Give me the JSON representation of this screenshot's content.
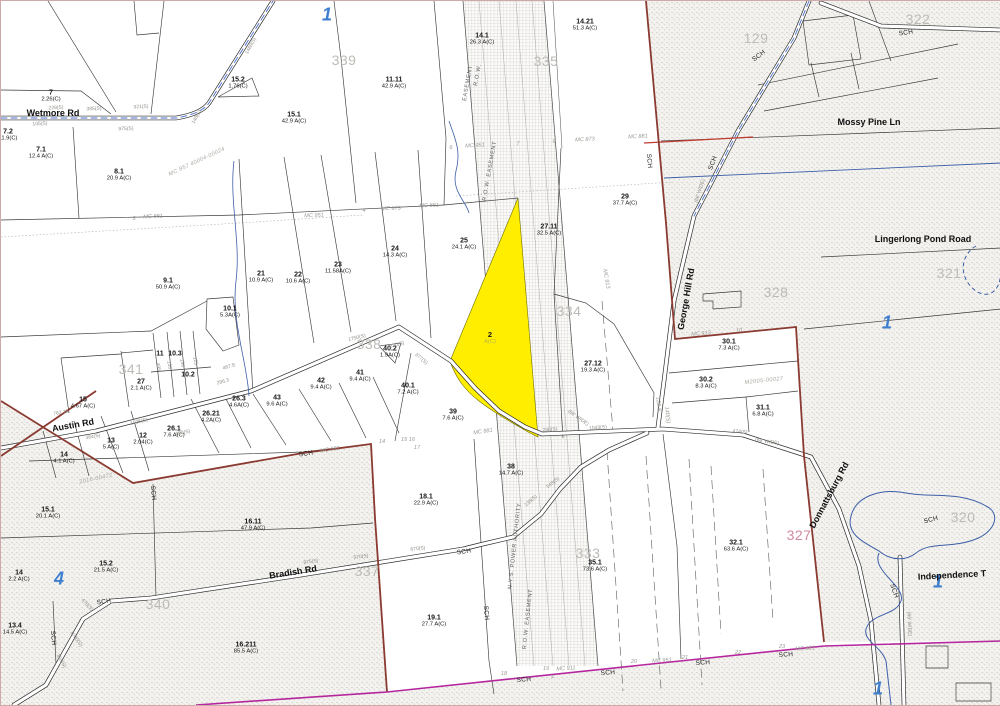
{
  "map": {
    "title": "Tax parcel map",
    "colors": {
      "highlight_parcel": "#ffee00",
      "boundary_maroon": "#8a3a30",
      "boundary_magenta": "#b5279d",
      "red_line": "#c03c30",
      "water": "#3c5fa8",
      "road_centerline": "#4a6fd0",
      "zone_number": "#3f7fd0",
      "sheet_number": "#bdbbb6"
    },
    "highlight_parcel": {
      "id": "2",
      "sub": "A(C)",
      "x": 489,
      "y": 337
    },
    "parcel_labels": [
      {
        "id": "7",
        "a": "2.26(C)",
        "x": 50,
        "y": 95
      },
      {
        "id": "7.2",
        "a": "11.9(C)",
        "x": 7,
        "y": 134
      },
      {
        "id": "7.1",
        "a": "12.4 A(C)",
        "x": 40,
        "y": 152
      },
      {
        "id": "8.1",
        "a": "20.9 A(C)",
        "x": 118,
        "y": 174
      },
      {
        "id": "15.2",
        "a": "1.76(C)",
        "x": 237,
        "y": 82
      },
      {
        "id": "15.1",
        "a": "42.9 A(C)",
        "x": 293,
        "y": 117
      },
      {
        "id": "11.11",
        "a": "42.9 A(C)",
        "x": 393,
        "y": 82
      },
      {
        "id": "14.1",
        "a": "26.3 A(C)",
        "x": 481,
        "y": 38
      },
      {
        "id": "14.21",
        "a": "51.3 A(C)",
        "x": 584,
        "y": 24
      },
      {
        "id": "29",
        "a": "37.7 A(C)",
        "x": 624,
        "y": 199
      },
      {
        "id": "27.11",
        "a": "32.5 A(C)",
        "x": 548,
        "y": 229
      },
      {
        "id": "25",
        "a": "24.1 A(C)",
        "x": 463,
        "y": 243
      },
      {
        "id": "24",
        "a": "14.3 A(C)",
        "x": 394,
        "y": 251
      },
      {
        "id": "23",
        "a": "11.58A(C)",
        "x": 337,
        "y": 267
      },
      {
        "id": "22",
        "a": "10.6 A(C)",
        "x": 297,
        "y": 277
      },
      {
        "id": "21",
        "a": "10.9 A(C)",
        "x": 260,
        "y": 276
      },
      {
        "id": "9.1",
        "a": "50.9 A(C)",
        "x": 167,
        "y": 283
      },
      {
        "id": "10.1",
        "a": "5.3A(C)",
        "x": 229,
        "y": 311
      },
      {
        "id": "27.12",
        "a": "19.3 A(C)",
        "x": 592,
        "y": 366
      },
      {
        "id": "30.1",
        "a": "7.3 A(C)",
        "x": 728,
        "y": 344
      },
      {
        "id": "30.2",
        "a": "8.3 A(C)",
        "x": 705,
        "y": 382
      },
      {
        "id": "31.1",
        "a": "6.8 A(C)",
        "x": 762,
        "y": 410
      },
      {
        "id": "40.2",
        "a": "1.9A(C)",
        "x": 389,
        "y": 351
      },
      {
        "id": "41",
        "a": "9.4 A(C)",
        "x": 359,
        "y": 375
      },
      {
        "id": "42",
        "a": "9.4 A(C)",
        "x": 320,
        "y": 383
      },
      {
        "id": "43",
        "a": "9.6 A(C)",
        "x": 276,
        "y": 400
      },
      {
        "id": "40.1",
        "a": "7.2 A(C)",
        "x": 407,
        "y": 388
      },
      {
        "id": "39",
        "a": "7.6 A(C)",
        "x": 452,
        "y": 414
      },
      {
        "id": "11",
        "a": "",
        "x": 159,
        "y": 353
      },
      {
        "id": "10.3",
        "a": "",
        "x": 174,
        "y": 353
      },
      {
        "id": "10.2",
        "a": "",
        "x": 187,
        "y": 374
      },
      {
        "id": "15",
        "a": "4.67 A(C)",
        "x": 82,
        "y": 402
      },
      {
        "id": "27",
        "a": "2.1 A(C)",
        "x": 140,
        "y": 384
      },
      {
        "id": "26.1",
        "a": "7.6 A(C)",
        "x": 173,
        "y": 431
      },
      {
        "id": "26.21",
        "a": "4.2A(C)",
        "x": 210,
        "y": 416
      },
      {
        "id": "26.3",
        "a": "4.6A(C)",
        "x": 238,
        "y": 401
      },
      {
        "id": "13",
        "a": "5 A(C)",
        "x": 110,
        "y": 443
      },
      {
        "id": "12",
        "a": "2.04(C)",
        "x": 142,
        "y": 438
      },
      {
        "id": "14",
        "a": "4.1 A(C)",
        "x": 63,
        "y": 457
      },
      {
        "id": "38",
        "a": "14.7 A(C)",
        "x": 510,
        "y": 469
      },
      {
        "id": "18.1",
        "a": "22.9 A(C)",
        "x": 425,
        "y": 499
      },
      {
        "id": "19.1",
        "a": "27.7 A(C)",
        "x": 433,
        "y": 620
      },
      {
        "id": "35.1",
        "a": "73.6 A(C)",
        "x": 594,
        "y": 565
      },
      {
        "id": "32.1",
        "a": "63.6 A(C)",
        "x": 735,
        "y": 545
      },
      {
        "id": "15.1",
        "a": "20.1 A(C)",
        "x": 47,
        "y": 512
      },
      {
        "id": "15.2",
        "a": "21.5 A(C)",
        "x": 105,
        "y": 566
      },
      {
        "id": "16.11",
        "a": "47.9 A(C)",
        "x": 252,
        "y": 524
      },
      {
        "id": "14",
        "a": "2.2 A(C)",
        "x": 18,
        "y": 575
      },
      {
        "id": "13.4",
        "a": "14.5 A(C)",
        "x": 14,
        "y": 628
      },
      {
        "id": "16.211",
        "a": "85.5 A(C)",
        "x": 245,
        "y": 647
      }
    ],
    "sheet_numbers": [
      {
        "t": "339",
        "x": 343,
        "y": 59
      },
      {
        "t": "335",
        "x": 545,
        "y": 60
      },
      {
        "t": "334",
        "x": 568,
        "y": 310
      },
      {
        "t": "338",
        "x": 368,
        "y": 343
      },
      {
        "t": "341",
        "x": 130,
        "y": 368
      },
      {
        "t": "129",
        "x": 755,
        "y": 37
      },
      {
        "t": "322",
        "x": 917,
        "y": 18
      },
      {
        "t": "328",
        "x": 775,
        "y": 291
      },
      {
        "t": "321",
        "x": 948,
        "y": 272
      },
      {
        "t": "320",
        "x": 962,
        "y": 516
      },
      {
        "t": "327",
        "x": 798,
        "y": 534,
        "c": "#cf8aa0"
      },
      {
        "t": "333",
        "x": 587,
        "y": 552
      },
      {
        "t": "340",
        "x": 157,
        "y": 603
      },
      {
        "t": "337",
        "x": 366,
        "y": 570
      }
    ],
    "zone_numbers": [
      {
        "t": "1",
        "x": 326,
        "y": 14
      },
      {
        "t": "1",
        "x": 886,
        "y": 322
      },
      {
        "t": "1",
        "x": 937,
        "y": 581
      },
      {
        "t": "1",
        "x": 877,
        "y": 688
      },
      {
        "t": "4",
        "x": 58,
        "y": 578
      }
    ],
    "road_labels": [
      {
        "t": "Wetmore Rd",
        "x": 52,
        "y": 112,
        "r": 0
      },
      {
        "t": "Austin Rd",
        "x": 72,
        "y": 424,
        "r": -10
      },
      {
        "t": "Bradish Rd",
        "x": 292,
        "y": 571,
        "r": -9
      },
      {
        "t": "George Hill Rd",
        "x": 685,
        "y": 298,
        "r": -80
      },
      {
        "t": "Mossy Pine Ln",
        "x": 868,
        "y": 121,
        "r": 0
      },
      {
        "t": "Lingerlong Pond Road",
        "x": 922,
        "y": 238,
        "r": 0
      },
      {
        "t": "Donnattsburg Rd",
        "x": 828,
        "y": 494,
        "r": -62
      },
      {
        "t": "Independence T",
        "x": 951,
        "y": 574,
        "r": -3
      }
    ],
    "sch_labels": [
      {
        "x": 305,
        "y": 453,
        "r": -8
      },
      {
        "x": 103,
        "y": 601,
        "r": -8
      },
      {
        "x": 463,
        "y": 551,
        "r": -8
      },
      {
        "x": 485,
        "y": 612,
        "r": 85
      },
      {
        "x": 152,
        "y": 492,
        "r": 85
      },
      {
        "x": 52,
        "y": 637,
        "r": 85
      },
      {
        "x": 523,
        "y": 679,
        "r": -4
      },
      {
        "x": 607,
        "y": 672,
        "r": -4
      },
      {
        "x": 702,
        "y": 662,
        "r": -4
      },
      {
        "x": 785,
        "y": 654,
        "r": -4
      },
      {
        "x": 758,
        "y": 55,
        "r": -38
      },
      {
        "x": 712,
        "y": 162,
        "r": -70
      },
      {
        "x": 905,
        "y": 32,
        "r": -8
      },
      {
        "x": 930,
        "y": 519,
        "r": -15
      },
      {
        "x": 893,
        "y": 590,
        "r": 70
      },
      {
        "x": 648,
        "y": 160,
        "r": 85
      }
    ],
    "line_labels": [
      {
        "t": "6",
        "x": 450,
        "y": 147,
        "r": -3
      },
      {
        "t": "MC 951",
        "x": 474,
        "y": 145,
        "r": -3
      },
      {
        "t": "7",
        "x": 517,
        "y": 143,
        "r": -3
      },
      {
        "t": "9",
        "x": 553,
        "y": 141,
        "r": -3
      },
      {
        "t": "MC 873",
        "x": 584,
        "y": 139,
        "r": -3
      },
      {
        "t": "MC 881",
        "x": 637,
        "y": 136,
        "r": -3
      },
      {
        "t": "3",
        "x": 133,
        "y": 218,
        "r": 0
      },
      {
        "t": "MC 881",
        "x": 152,
        "y": 216,
        "r": -2
      },
      {
        "t": "MC 951",
        "x": 313,
        "y": 215,
        "r": -2
      },
      {
        "t": "4",
        "x": 363,
        "y": 210,
        "r": 0
      },
      {
        "t": "MC 873",
        "x": 390,
        "y": 208,
        "r": -2
      },
      {
        "t": "MC 881",
        "x": 428,
        "y": 205,
        "r": -2
      },
      {
        "t": "MC 951",
        "x": 329,
        "y": 449,
        "r": -8
      },
      {
        "t": "14",
        "x": 381,
        "y": 441,
        "r": 0
      },
      {
        "t": "15 16",
        "x": 407,
        "y": 439,
        "r": 0
      },
      {
        "t": "17",
        "x": 416,
        "y": 447,
        "r": 0
      },
      {
        "t": "MC 881",
        "x": 482,
        "y": 431,
        "r": -8
      },
      {
        "t": "18",
        "x": 503,
        "y": 673,
        "r": 0
      },
      {
        "t": "F",
        "x": 552,
        "y": 677,
        "r": 0
      },
      {
        "t": "19",
        "x": 545,
        "y": 668,
        "r": 0
      },
      {
        "t": "MC 911",
        "x": 565,
        "y": 668,
        "r": -4
      },
      {
        "t": "20",
        "x": 633,
        "y": 661,
        "r": 0
      },
      {
        "t": "MC 951",
        "x": 661,
        "y": 660,
        "r": -4
      },
      {
        "t": "21",
        "x": 684,
        "y": 657,
        "r": 0
      },
      {
        "t": "22",
        "x": 737,
        "y": 652,
        "r": 0
      },
      {
        "t": "23",
        "x": 781,
        "y": 646,
        "r": 0
      },
      {
        "t": "MC 881",
        "x": 804,
        "y": 648,
        "r": -4
      },
      {
        "t": "MC 913",
        "x": 700,
        "y": 333,
        "r": -5
      },
      {
        "t": "10",
        "x": 738,
        "y": 330,
        "r": -5
      },
      {
        "t": "MC 913",
        "x": 605,
        "y": 278,
        "r": 80
      },
      {
        "t": "122.8",
        "x": 657,
        "y": 403,
        "r": 85
      },
      {
        "t": "140(S)",
        "x": 666,
        "y": 414,
        "r": 85
      }
    ],
    "distance_labels": [
      {
        "t": "385(S)",
        "x": 93,
        "y": 108,
        "r": -3
      },
      {
        "t": "321(S)",
        "x": 140,
        "y": 106,
        "r": -3
      },
      {
        "t": "975(S)",
        "x": 125,
        "y": 128,
        "r": -3
      },
      {
        "t": "229(S)",
        "x": 55,
        "y": 107,
        "r": -3
      },
      {
        "t": "105(S)",
        "x": 39,
        "y": 123,
        "r": -3
      },
      {
        "t": "148(S)",
        "x": 196,
        "y": 116,
        "r": -60
      },
      {
        "t": "1460(S)",
        "x": 250,
        "y": 45,
        "r": -62
      },
      {
        "t": "762.78",
        "x": 60,
        "y": 412,
        "r": -10
      },
      {
        "t": "384(S)",
        "x": 92,
        "y": 436,
        "r": -10
      },
      {
        "t": "1025(S)",
        "x": 138,
        "y": 421,
        "r": -12
      },
      {
        "t": "490(S)",
        "x": 182,
        "y": 432,
        "r": -12
      },
      {
        "t": "467.8",
        "x": 228,
        "y": 366,
        "r": -16
      },
      {
        "t": "296.3",
        "x": 222,
        "y": 381,
        "r": -16
      },
      {
        "t": "1750(S)",
        "x": 356,
        "y": 337,
        "r": -14
      },
      {
        "t": "520(S)",
        "x": 396,
        "y": 344,
        "r": -14
      },
      {
        "t": "377(S)",
        "x": 420,
        "y": 358,
        "r": 40
      },
      {
        "t": "236(S)",
        "x": 549,
        "y": 429,
        "r": -5
      },
      {
        "t": "1043(S)",
        "x": 597,
        "y": 427,
        "r": -5
      },
      {
        "t": "474(S)",
        "x": 739,
        "y": 431,
        "r": 5
      },
      {
        "t": "(66' WIDE)",
        "x": 766,
        "y": 441,
        "r": 8
      },
      {
        "t": "(66' WIDE)",
        "x": 577,
        "y": 417,
        "r": 35
      },
      {
        "t": "(66' WIDE)",
        "x": 699,
        "y": 190,
        "r": -72
      },
      {
        "t": "(66' WIDE)",
        "x": 908,
        "y": 623,
        "r": 88
      },
      {
        "t": "670(S)",
        "x": 417,
        "y": 548,
        "r": -7
      },
      {
        "t": "975(S)",
        "x": 310,
        "y": 561,
        "r": -8
      },
      {
        "t": "570(S)",
        "x": 360,
        "y": 556,
        "r": -8
      },
      {
        "t": "548(S)",
        "x": 552,
        "y": 482,
        "r": -38
      },
      {
        "t": "138(S)",
        "x": 530,
        "y": 500,
        "r": -42
      },
      {
        "t": "1000(S)",
        "x": 75,
        "y": 638,
        "r": 55
      },
      {
        "t": "470(S)",
        "x": 86,
        "y": 604,
        "r": 45
      },
      {
        "t": "368(S)",
        "x": 60,
        "y": 660,
        "r": 60
      },
      {
        "t": "130",
        "x": 168,
        "y": 364,
        "r": 78
      },
      {
        "t": "150",
        "x": 181,
        "y": 362,
        "r": 78
      },
      {
        "t": "125",
        "x": 194,
        "y": 360,
        "r": 78
      },
      {
        "t": "495",
        "x": 157,
        "y": 366,
        "r": 78
      }
    ],
    "easement_labels": [
      {
        "t": "EASEMENT",
        "x": 467,
        "y": 82,
        "r": -80
      },
      {
        "t": "R.O.W.",
        "x": 477,
        "y": 74,
        "r": -80
      },
      {
        "t": "N.Y.S. POWER AUTHORITY",
        "x": 514,
        "y": 545,
        "r": -84
      },
      {
        "t": "R.O.W. EASEMENT",
        "x": 527,
        "y": 618,
        "r": -84
      },
      {
        "t": "R.O.W. EASEMENT",
        "x": 489,
        "y": 170,
        "r": -80
      }
    ],
    "instrument_labels": [
      {
        "t": "MC 857 40004-00024",
        "x": 196,
        "y": 161,
        "r": -25
      },
      {
        "t": "2016-00472",
        "x": 95,
        "y": 478,
        "r": -12
      },
      {
        "t": "M2005-00027",
        "x": 763,
        "y": 380,
        "r": -6
      }
    ]
  }
}
